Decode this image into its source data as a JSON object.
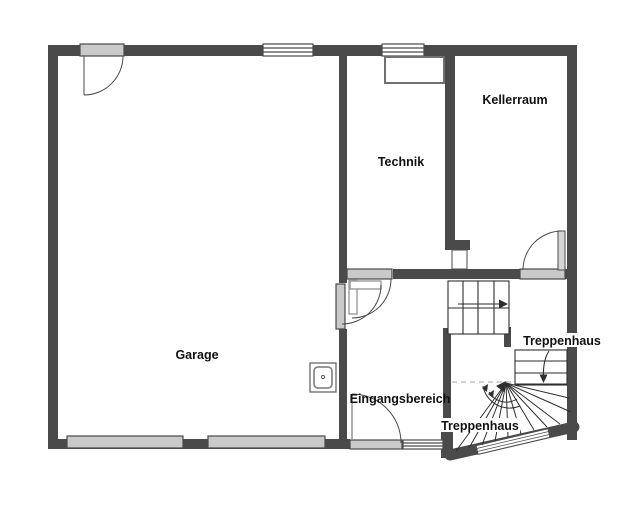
{
  "plan": {
    "title": "Basement floor plan",
    "rooms": [
      {
        "id": "garage",
        "label": "Garage"
      },
      {
        "id": "technik",
        "label": "Technik"
      },
      {
        "id": "kellerraum",
        "label": "Kellerraum"
      },
      {
        "id": "eingangsbereich",
        "label": "Eingangsbereich"
      },
      {
        "id": "treppenhaus-1",
        "label": "Treppenhaus"
      },
      {
        "id": "treppenhaus-2",
        "label": "Treppenhaus"
      }
    ],
    "colors": {
      "wall": "#4a4a4a",
      "door_fill": "#c9c9c9",
      "door_leaf": "#d6d6d6",
      "window_fill": "#ffffff",
      "stair_line": "#2e2e2e",
      "dashed_line": "#c4c4c4",
      "background": "#ffffff"
    }
  }
}
